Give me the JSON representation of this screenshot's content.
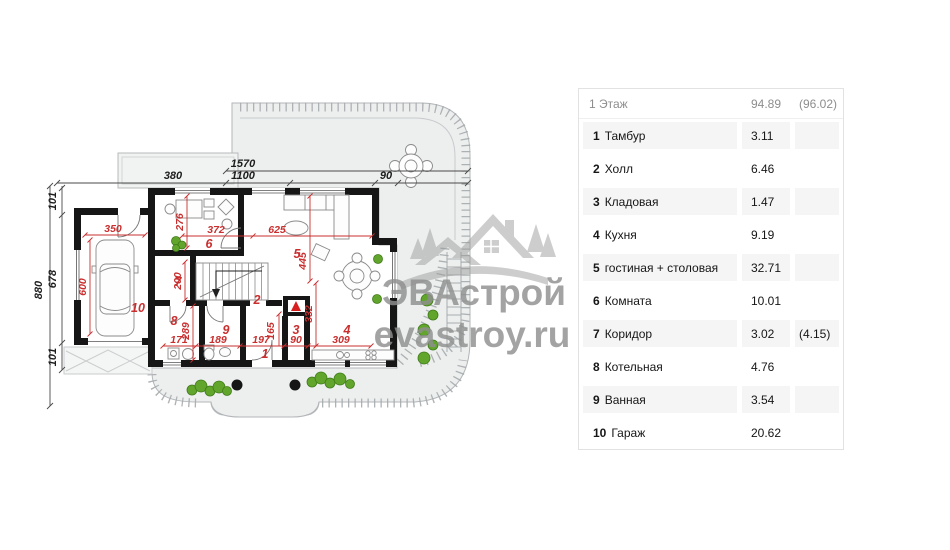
{
  "watermark": {
    "brand": "ЭВАстрой",
    "site": "evastroy.ru"
  },
  "table": {
    "header": {
      "label": "1 Этаж",
      "area": "94.89",
      "area_alt": "(96.02)"
    },
    "rows": [
      {
        "num": "1",
        "label": "Тамбур",
        "area": "3.11",
        "alt": ""
      },
      {
        "num": "2",
        "label": "Холл",
        "area": "6.46",
        "alt": ""
      },
      {
        "num": "3",
        "label": "Кладовая",
        "area": "1.47",
        "alt": ""
      },
      {
        "num": "4",
        "label": "Кухня",
        "area": "9.19",
        "alt": ""
      },
      {
        "num": "5",
        "label": "гостиная + столовая",
        "area": "32.71",
        "alt": ""
      },
      {
        "num": "6",
        "label": "Комната",
        "area": "10.01",
        "alt": ""
      },
      {
        "num": "7",
        "label": "Коридор",
        "area": "3.02",
        "alt": "(4.15)"
      },
      {
        "num": "8",
        "label": "Котельная",
        "area": "4.76",
        "alt": ""
      },
      {
        "num": "9",
        "label": "Ванная",
        "area": "3.54",
        "alt": ""
      },
      {
        "num": "10",
        "label": "Гараж",
        "area": "20.62",
        "alt": ""
      }
    ]
  },
  "plan": {
    "outer_dims": {
      "total_width": "1570",
      "left_width": "380",
      "inner_width": "1100",
      "right_width": "90",
      "total_height": "880",
      "top_height": "101",
      "mid_height": "678",
      "bottom_height": "101"
    },
    "inner_dims": {
      "garage_w": "350",
      "garage_h": "600",
      "room6_h": "276",
      "room6_w": "372",
      "living_w": "625",
      "living_h": "445",
      "corridor_h": "200",
      "boiler_h": "289",
      "boiler_w": "171",
      "bath_w": "189",
      "tambour_w": "197",
      "tambour_h": "165",
      "pantry_w": "90",
      "kitchen_w": "309",
      "kitchen_h": "332"
    },
    "rooms": {
      "n1": "1",
      "n2": "2",
      "n3": "3",
      "n4": "4",
      "n5": "5",
      "n6": "6",
      "n7": "7",
      "n8": "8",
      "n9": "9",
      "n10": "10"
    }
  }
}
